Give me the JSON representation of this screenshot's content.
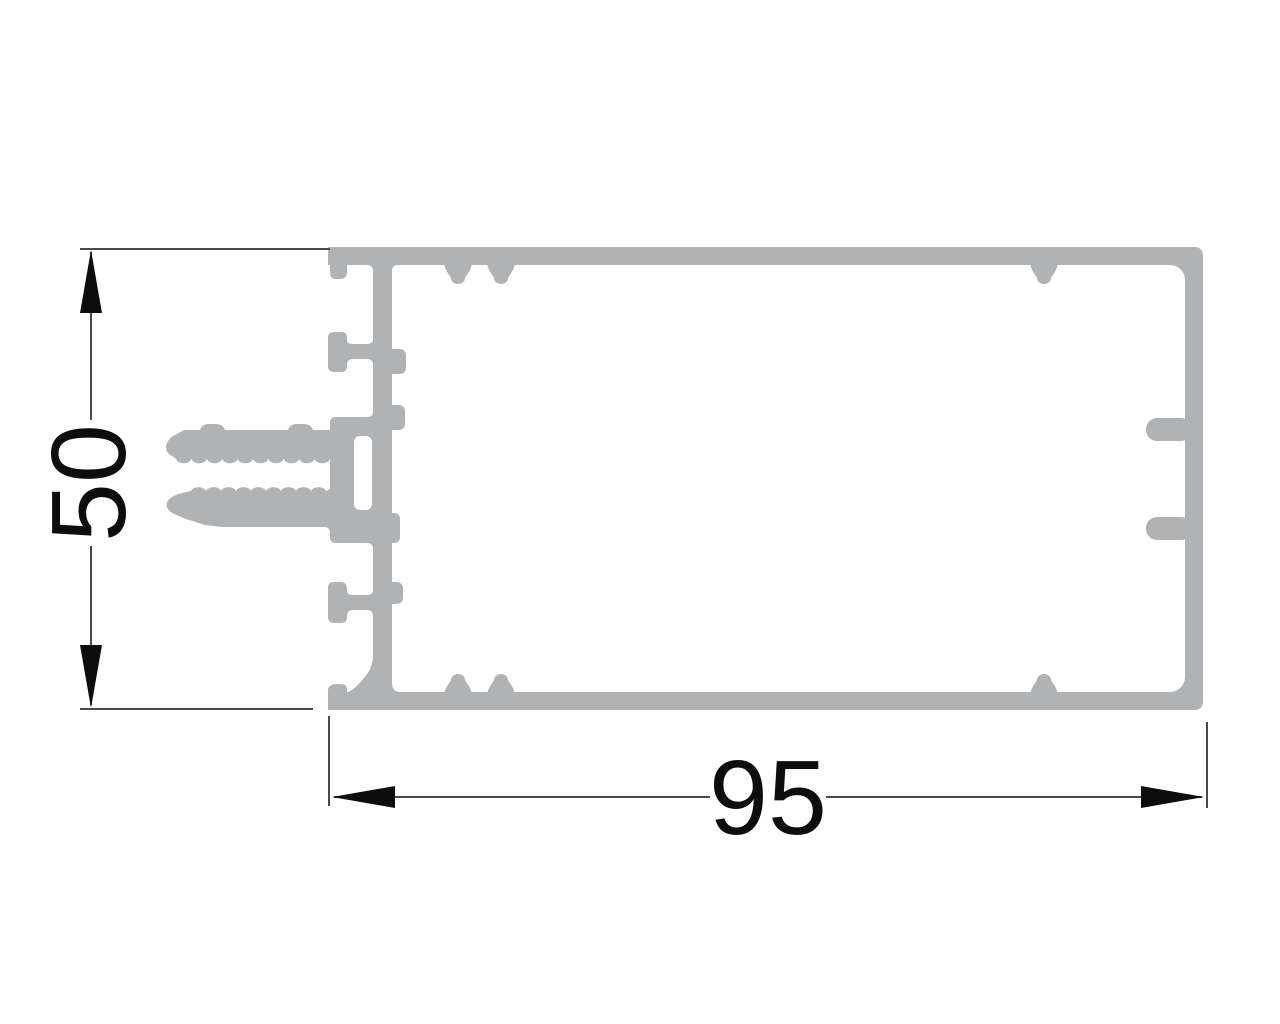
{
  "figure": {
    "title": "aluminium profile cross-section drawing",
    "background_color": "#ffffff"
  },
  "profile": {
    "shape": "rectangular hollow glazing profile with gasket hooks, two serrated screw prongs, two tee flanges and inner clip tabs",
    "fill_color": "#b0b2b4"
  },
  "dimensions": {
    "width": {
      "value": "95",
      "orientation": "horizontal",
      "position": "below profile"
    },
    "height": {
      "value": "50",
      "orientation": "vertical",
      "position": "left of profile"
    },
    "line_color": "#4a4a4a",
    "arrow_color": "#0d0d0d",
    "text_color": "#0d0d0d"
  }
}
